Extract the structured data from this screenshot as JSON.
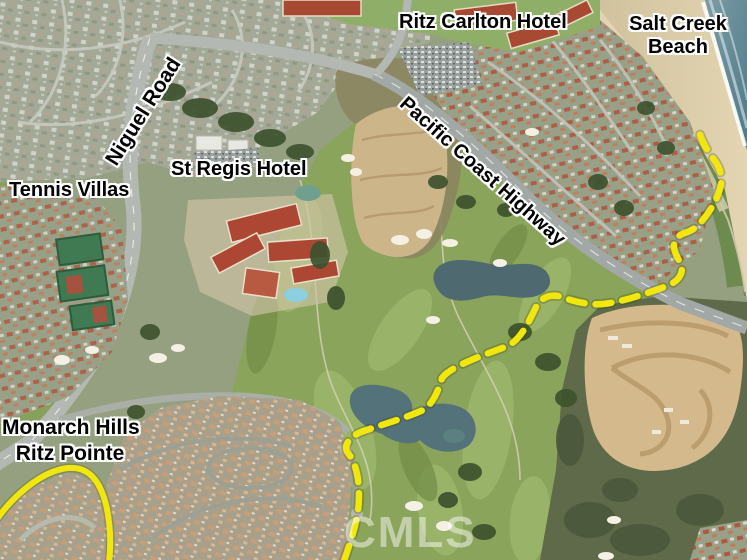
{
  "map": {
    "labels": {
      "ritz_carlton_hotel": "Ritz Carlton Hotel",
      "salt_creek_beach_line1": "Salt Creek",
      "salt_creek_beach_line2": "Beach",
      "niguel_road": "Niguel Road",
      "tennis_villas": "Tennis Villas",
      "st_regis_hotel": "St Regis Hotel",
      "pacific_coast_highway": "Pacific Coast Highway",
      "monarch_hills_line1": "Monarch Hills",
      "monarch_hills_line2": "Ritz Pointe"
    },
    "watermark": "CMLS",
    "colors": {
      "route_yellow": "#F2E70C",
      "label_text": "#000000",
      "label_halo": "#FFFFFF",
      "ocean": "#5E8494",
      "beach_sand": "#DBCBA6",
      "golf_green": "#8AA45C",
      "dirt_tan": "#CDB488"
    }
  }
}
